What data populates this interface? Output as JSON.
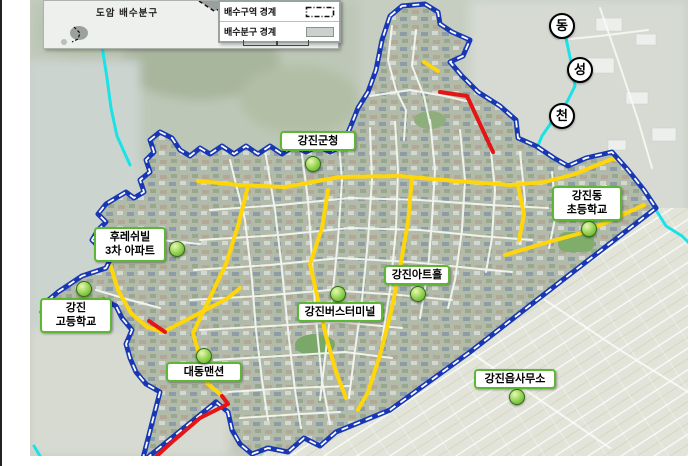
{
  "inset_map": {
    "district_label": "도암 배수분구"
  },
  "legend": {
    "items": [
      {
        "label": "배수구역 경계",
        "symbol": "dash-dot-rectangle"
      },
      {
        "label": "배수분구 경계",
        "symbol": "gray-filled-rectangle"
      }
    ]
  },
  "stream_label_circles": [
    {
      "char": "동",
      "x": 560,
      "y": 24
    },
    {
      "char": "성",
      "x": 578,
      "y": 68
    },
    {
      "char": "천",
      "x": 560,
      "y": 114
    }
  ],
  "landmarks": [
    {
      "id": "gangjin-county-office",
      "lines": [
        "강진군청"
      ],
      "label": {
        "left": 280,
        "top": 131,
        "width": 76
      },
      "marker": {
        "x": 312,
        "y": 163
      }
    },
    {
      "id": "gangjindong-elementary-school",
      "lines": [
        "강진동",
        "초등학교"
      ],
      "label": {
        "left": 552,
        "top": 186,
        "width": 70
      },
      "marker": {
        "x": 588,
        "y": 228
      }
    },
    {
      "id": "freshville-3cha-apartment",
      "lines": [
        "후레쉬빌",
        "3차 아파트"
      ],
      "label": {
        "left": 94,
        "top": 227,
        "width": 72
      },
      "marker": {
        "x": 176,
        "y": 248
      }
    },
    {
      "id": "gangjin-high-school",
      "lines": [
        "강진",
        "고등학교"
      ],
      "label": {
        "left": 40,
        "top": 298,
        "width": 72
      },
      "marker": {
        "x": 83,
        "y": 288
      }
    },
    {
      "id": "daedong-mansion",
      "lines": [
        "대동맨션"
      ],
      "label": {
        "left": 166,
        "top": 362,
        "width": 76
      },
      "marker": {
        "x": 203,
        "y": 355
      }
    },
    {
      "id": "gangjin-bus-terminal",
      "lines": [
        "강진버스터미널"
      ],
      "label": {
        "left": 297,
        "top": 302,
        "width": 86
      },
      "marker": {
        "x": 337,
        "y": 293
      }
    },
    {
      "id": "gangjin-art-hall",
      "lines": [
        "강진아트홀"
      ],
      "label": {
        "left": 384,
        "top": 265,
        "width": 66
      },
      "marker": {
        "x": 417,
        "y": 293
      }
    },
    {
      "id": "gangjin-eup-office",
      "lines": [
        "강진읍사무소"
      ],
      "label": {
        "left": 474,
        "top": 369,
        "width": 82
      },
      "marker": {
        "x": 516,
        "y": 396
      }
    }
  ],
  "colors": {
    "boundary_blue": "#1837b5",
    "road_yellow": "#ffd60a",
    "road_highlight_red": "#e51515",
    "stream_cyan": "#1ae2e6",
    "marker_green": "#8fd04e",
    "label_border_green": "#5cb832"
  }
}
